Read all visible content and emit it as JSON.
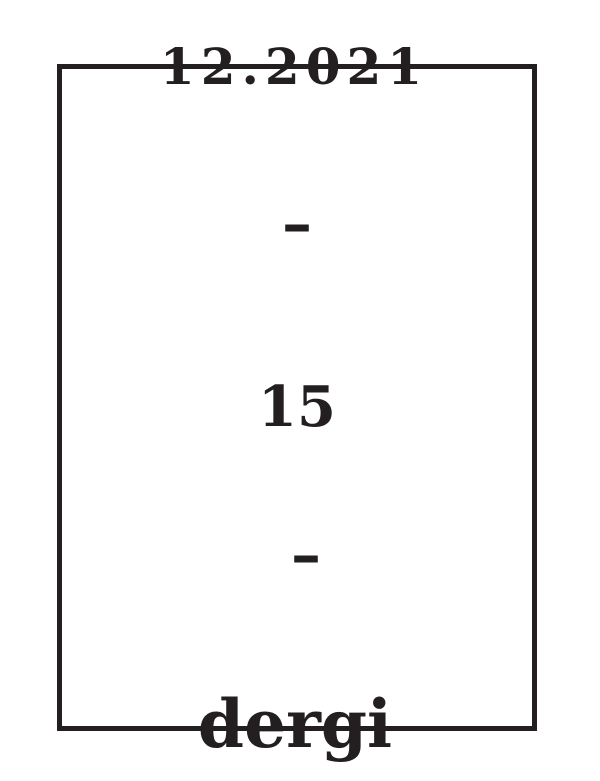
{
  "theme": {
    "ink": "#231f20",
    "background": "#ffffff"
  },
  "cover": {
    "date": "12.2021",
    "separator_top": "–",
    "issue_number": "15",
    "separator_bottom": "–",
    "title": "dergi"
  }
}
